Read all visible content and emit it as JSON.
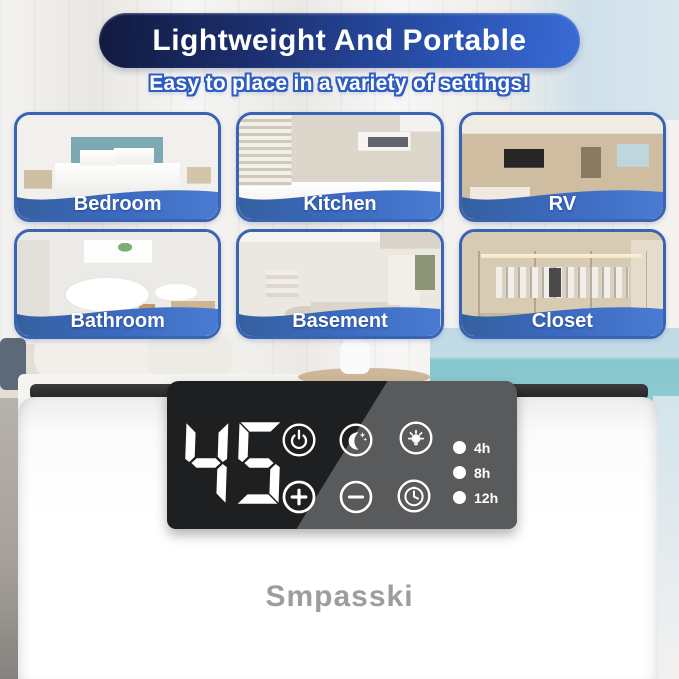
{
  "header": {
    "title": "Lightweight And Portable",
    "subtitle": "Easy to place in a variety of settings!"
  },
  "rooms": [
    {
      "label": "Bedroom"
    },
    {
      "label": "Kitchen"
    },
    {
      "label": "RV"
    },
    {
      "label": "Bathroom"
    },
    {
      "label": "Basement"
    },
    {
      "label": "Closet"
    }
  ],
  "device": {
    "brand": "Smpasski",
    "display_value": "45",
    "controls": [
      {
        "icon": "power-icon"
      },
      {
        "icon": "sleep-mode-icon"
      },
      {
        "icon": "light-icon"
      },
      {
        "icon": "plus-icon"
      },
      {
        "icon": "minus-icon"
      },
      {
        "icon": "timer-icon"
      }
    ],
    "timer_options": [
      {
        "label": "4h"
      },
      {
        "label": "8h"
      },
      {
        "label": "12h"
      }
    ]
  },
  "colors": {
    "banner_dark": "#111a3f",
    "banner_blue": "#3a6bd6",
    "band_blue": "#3c6ac0",
    "card_border": "#3a63b4",
    "panel_dark": "#1e1f21",
    "panel_sheen": "#595a5c",
    "brand_gray": "#9d9d9d"
  }
}
